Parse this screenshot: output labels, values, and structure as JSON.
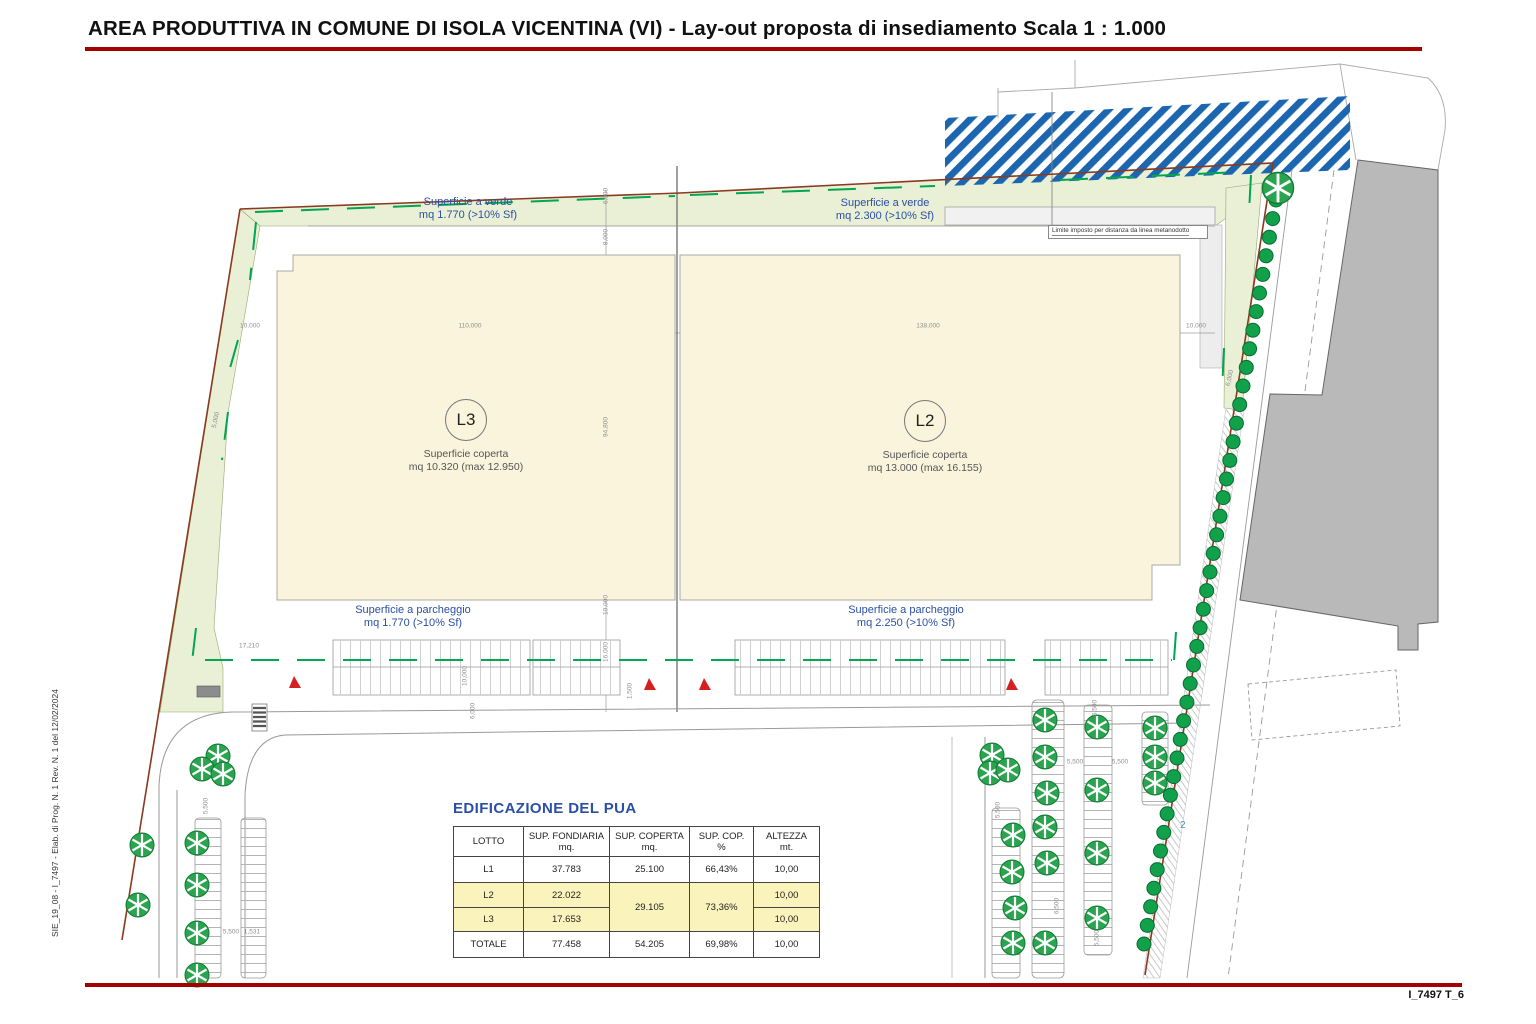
{
  "page": {
    "title": "AREA PRODUTTIVA IN COMUNE DI ISOLA VICENTINA (VI) - Lay-out proposta di insediamento Scala 1 : 1.000",
    "sheet_code": "I_7497 T_6",
    "side_note": "SIE_19_08 - I_7497 - Elab. di Prog. N. 1 Rev. N. 1 del 12/02/2024"
  },
  "colors": {
    "accent_red": "#a50000",
    "label_blue": "#2b4fa5",
    "green_area": "#e9f0d6",
    "building_beige": "#faf4dc",
    "hatch_blue": "#1c66b0",
    "dash_green": "#00a651",
    "boundary_brown": "#8a3a1e",
    "highlight_yellow": "#fbf3bc",
    "value_red": "#e03326",
    "existing_building_gray": "#b9b9b9"
  },
  "plan": {
    "verde_left": {
      "line1": "Superficie a verde",
      "line2": "mq 1.770 (>10% Sf)"
    },
    "verde_right": {
      "line1": "Superficie a verde",
      "line2": "mq 2.300 (>10% Sf)"
    },
    "parcheggio_left": {
      "line1": "Superficie a parcheggio",
      "line2": "mq 1.770 (>10% Sf)"
    },
    "parcheggio_right": {
      "line1": "Superficie a parcheggio",
      "line2": "mq 2.250 (>10% Sf)"
    },
    "lot_l3": {
      "label": "L3",
      "line1": "Superficie coperta",
      "line2": "mq 10.320 (max 12.950)"
    },
    "lot_l2": {
      "label": "L2",
      "line1": "Superficie coperta",
      "line2": "mq 13.000 (max 16.155)"
    },
    "limite_label": "Limite imposto per distanza da linea metanodotto",
    "road_number": "2",
    "icons": {
      "parking_tree": "spoked-green-circle",
      "street_tree": "solid-green-circle",
      "entrance_marker": "red-triangle",
      "crosswalk": "striped-bar",
      "gas_pipeline_constraint": "blue-diagonal-stripes"
    },
    "dimensions": [
      {
        "text": "10,000",
        "x": 250,
        "y": 326,
        "rot": 0
      },
      {
        "text": "110,000",
        "x": 470,
        "y": 326,
        "rot": 0
      },
      {
        "text": "138,000",
        "x": 928,
        "y": 326,
        "rot": 0
      },
      {
        "text": "10,000",
        "x": 1196,
        "y": 326,
        "rot": 0
      },
      {
        "text": "5,000",
        "x": 216,
        "y": 420,
        "rot": -78
      },
      {
        "text": "6,000",
        "x": 606,
        "y": 196,
        "rot": -90
      },
      {
        "text": "8,000",
        "x": 606,
        "y": 237,
        "rot": -90
      },
      {
        "text": "94,800",
        "x": 606,
        "y": 427,
        "rot": -90
      },
      {
        "text": "10,000",
        "x": 606,
        "y": 605,
        "rot": -90
      },
      {
        "text": "16,000",
        "x": 606,
        "y": 652,
        "rot": -90
      },
      {
        "text": "17,210",
        "x": 249,
        "y": 646,
        "rot": 0
      },
      {
        "text": "10,000",
        "x": 465,
        "y": 676,
        "rot": -90
      },
      {
        "text": "1,500",
        "x": 630,
        "y": 691,
        "rot": -90
      },
      {
        "text": "6,000",
        "x": 473,
        "y": 711,
        "rot": -90
      },
      {
        "text": "5,500",
        "x": 206,
        "y": 806,
        "rot": -90
      },
      {
        "text": "5,500",
        "x": 231,
        "y": 932,
        "rot": 0
      },
      {
        "text": "1,531",
        "x": 252,
        "y": 932,
        "rot": 0
      },
      {
        "text": "5,500",
        "x": 1075,
        "y": 762,
        "rot": 0
      },
      {
        "text": "5,500",
        "x": 1120,
        "y": 762,
        "rot": 0
      },
      {
        "text": "5,500",
        "x": 1095,
        "y": 708,
        "rot": -90
      },
      {
        "text": "6,500",
        "x": 1057,
        "y": 906,
        "rot": -90
      },
      {
        "text": "5,500",
        "x": 1097,
        "y": 938,
        "rot": -90
      },
      {
        "text": "5,500",
        "x": 998,
        "y": 810,
        "rot": -90
      },
      {
        "text": "6,000",
        "x": 1230,
        "y": 378,
        "rot": -78
      }
    ]
  },
  "table": {
    "title": "EDIFICAZIONE DEL PUA",
    "headers": {
      "lotto": "LOTTO",
      "fondiaria": "SUP. FONDIARIA\nmq.",
      "coperta": "SUP. COPERTA\nmq.",
      "cop": "SUP. COP.\n%",
      "altezza": "ALTEZZA\nmt."
    },
    "rows": {
      "l1": {
        "lotto": "L1",
        "fondiaria": "37.783",
        "coperta": "25.100",
        "cop": "66,43%",
        "altezza": "10,00"
      },
      "l2": {
        "lotto": "L2",
        "fondiaria": "22.022",
        "altezza": "10,00"
      },
      "l23_merged": {
        "coperta": "29.105",
        "cop": "73,36%"
      },
      "l3": {
        "lotto": "L3",
        "fondiaria": "17.653",
        "altezza": "10,00"
      },
      "totale": {
        "lotto": "TOTALE",
        "fondiaria": "77.458",
        "coperta": "54.205",
        "cop": "69,98%",
        "altezza": "10,00"
      }
    }
  }
}
